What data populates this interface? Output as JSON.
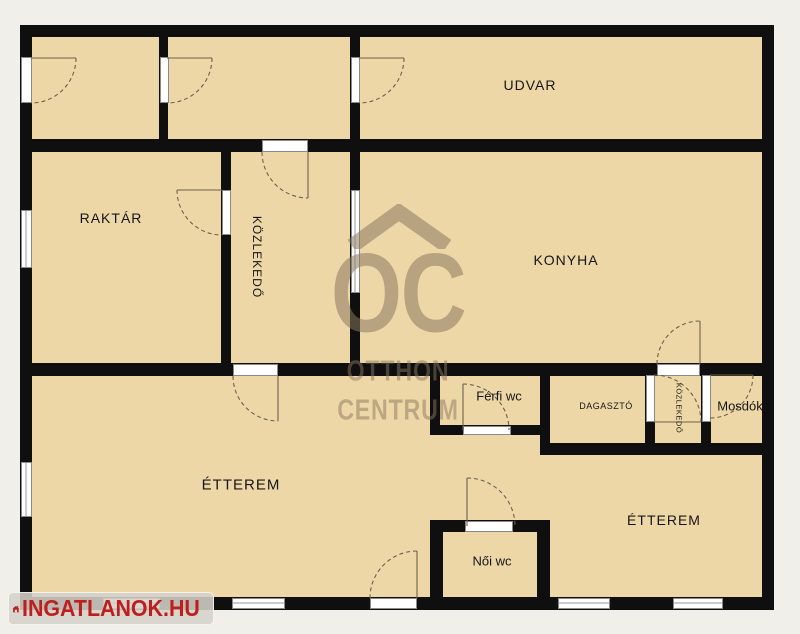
{
  "plan": {
    "rooms": {
      "udvar": {
        "label": "UDVAR"
      },
      "raktar": {
        "label": "RAKTÁR"
      },
      "kozlekedo_main": {
        "label": "KÖZLEKEDŐ"
      },
      "konyha": {
        "label": "KONYHA"
      },
      "ferfi_wc": {
        "label": "Férfi wc"
      },
      "dagaszto": {
        "label": "DAGASZTÓ"
      },
      "kozlekedo_small": {
        "label": "KÖZLEKEDŐ"
      },
      "mosdok": {
        "label": "Mosdók"
      },
      "etterem_left": {
        "label": "ÉTTEREM"
      },
      "etterem_right": {
        "label": "ÉTTEREM"
      },
      "noi_wc": {
        "label": "Női wc"
      }
    },
    "colors": {
      "background": "#f0efea",
      "room_fill": "#eed7a7",
      "wall": "#0f0f0f",
      "watermark": "#8a785e",
      "logo_red": "#bf1f1c"
    }
  },
  "watermark": {
    "monogram": "OC",
    "line1": "OTTHON",
    "line2": "CENTRUM"
  },
  "logo": {
    "text": "INGATLANOK.HU"
  }
}
